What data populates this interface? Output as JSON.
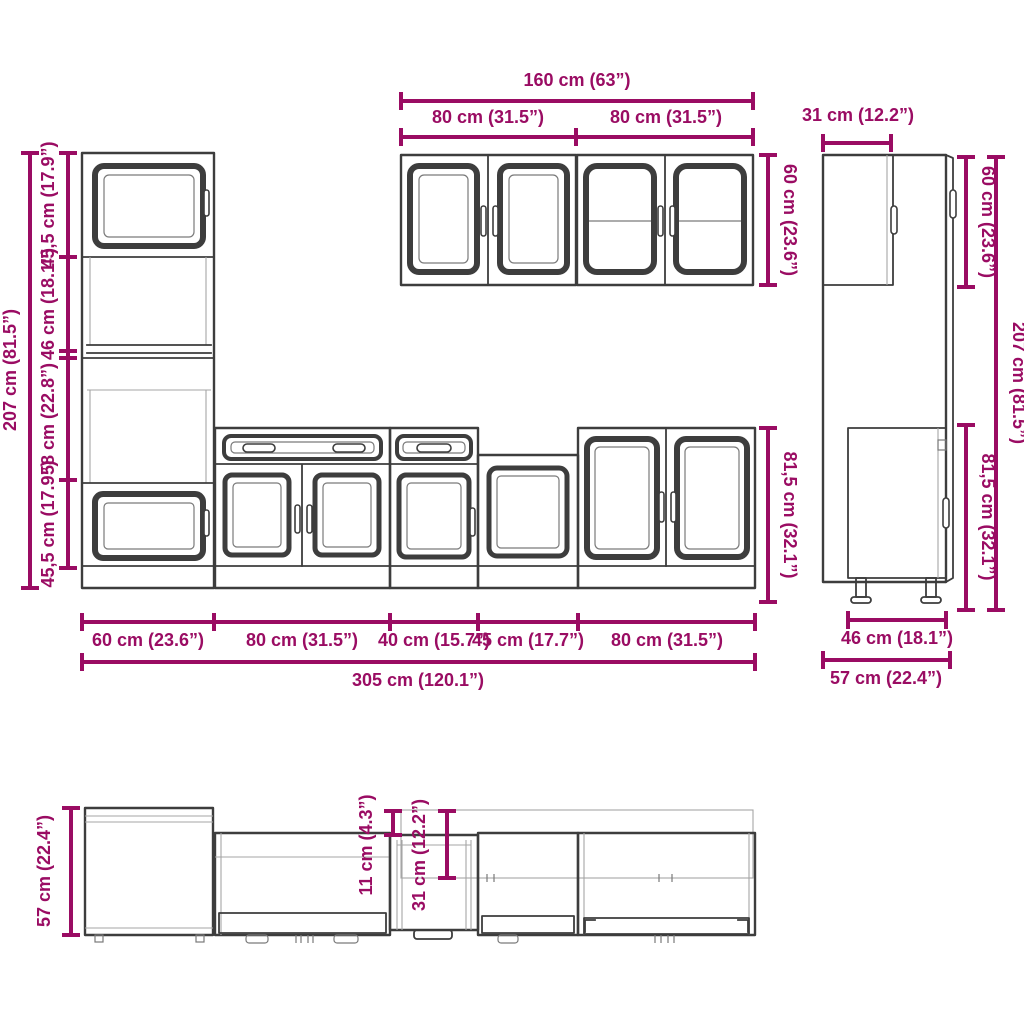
{
  "title": "kitchen-cabinet-set-dimension-diagram",
  "colors": {
    "dimension": "#9a0c63",
    "outline": "#3d3d3d",
    "light_line": "#a5a5a5",
    "background": "#ffffff"
  },
  "front_view": {
    "dims": {
      "wall_total_width": "160 cm (63”)",
      "wall_left_width": "80 cm (31.5”)",
      "wall_right_width": "80 cm (31.5”)",
      "wall_cabinet_height": "60 cm (23.6”)",
      "total_height": "207 cm (81.5”)",
      "tall_top_section": "45,5 cm (17.9”)",
      "tall_niche_section": "46 cm (18.1”)",
      "tall_mid_section": "58 cm (22.8”)",
      "tall_bottom_section": "45,5 cm (17.9”)",
      "base_cabinet_height": "81,5 cm (32.1”)",
      "tall_cabinet_width": "60 cm (23.6”)",
      "base1_width": "80 cm (31.5”)",
      "base2_width": "40 cm (15.7”)",
      "base3_width": "45 cm (17.7”)",
      "base4_width": "80 cm (31.5”)",
      "total_width": "305 cm (120.1”)"
    }
  },
  "side_view": {
    "dims": {
      "wall_cabinet_depth": "31 cm (12.2”)",
      "wall_cabinet_height": "60 cm (23.6”)",
      "total_height": "207 cm (81.5”)",
      "base_cabinet_height": "81,5 cm (32.1”)",
      "base_cabinet_depth": "46 cm (18.1”)",
      "total_depth": "57 cm (22.4”)"
    }
  },
  "plan_view": {
    "dims": {
      "total_depth": "57 cm (22.4”)",
      "depth_offset": "11 cm (4.3”)",
      "wall_cabinet_depth": "31 cm (12.2”)"
    }
  }
}
